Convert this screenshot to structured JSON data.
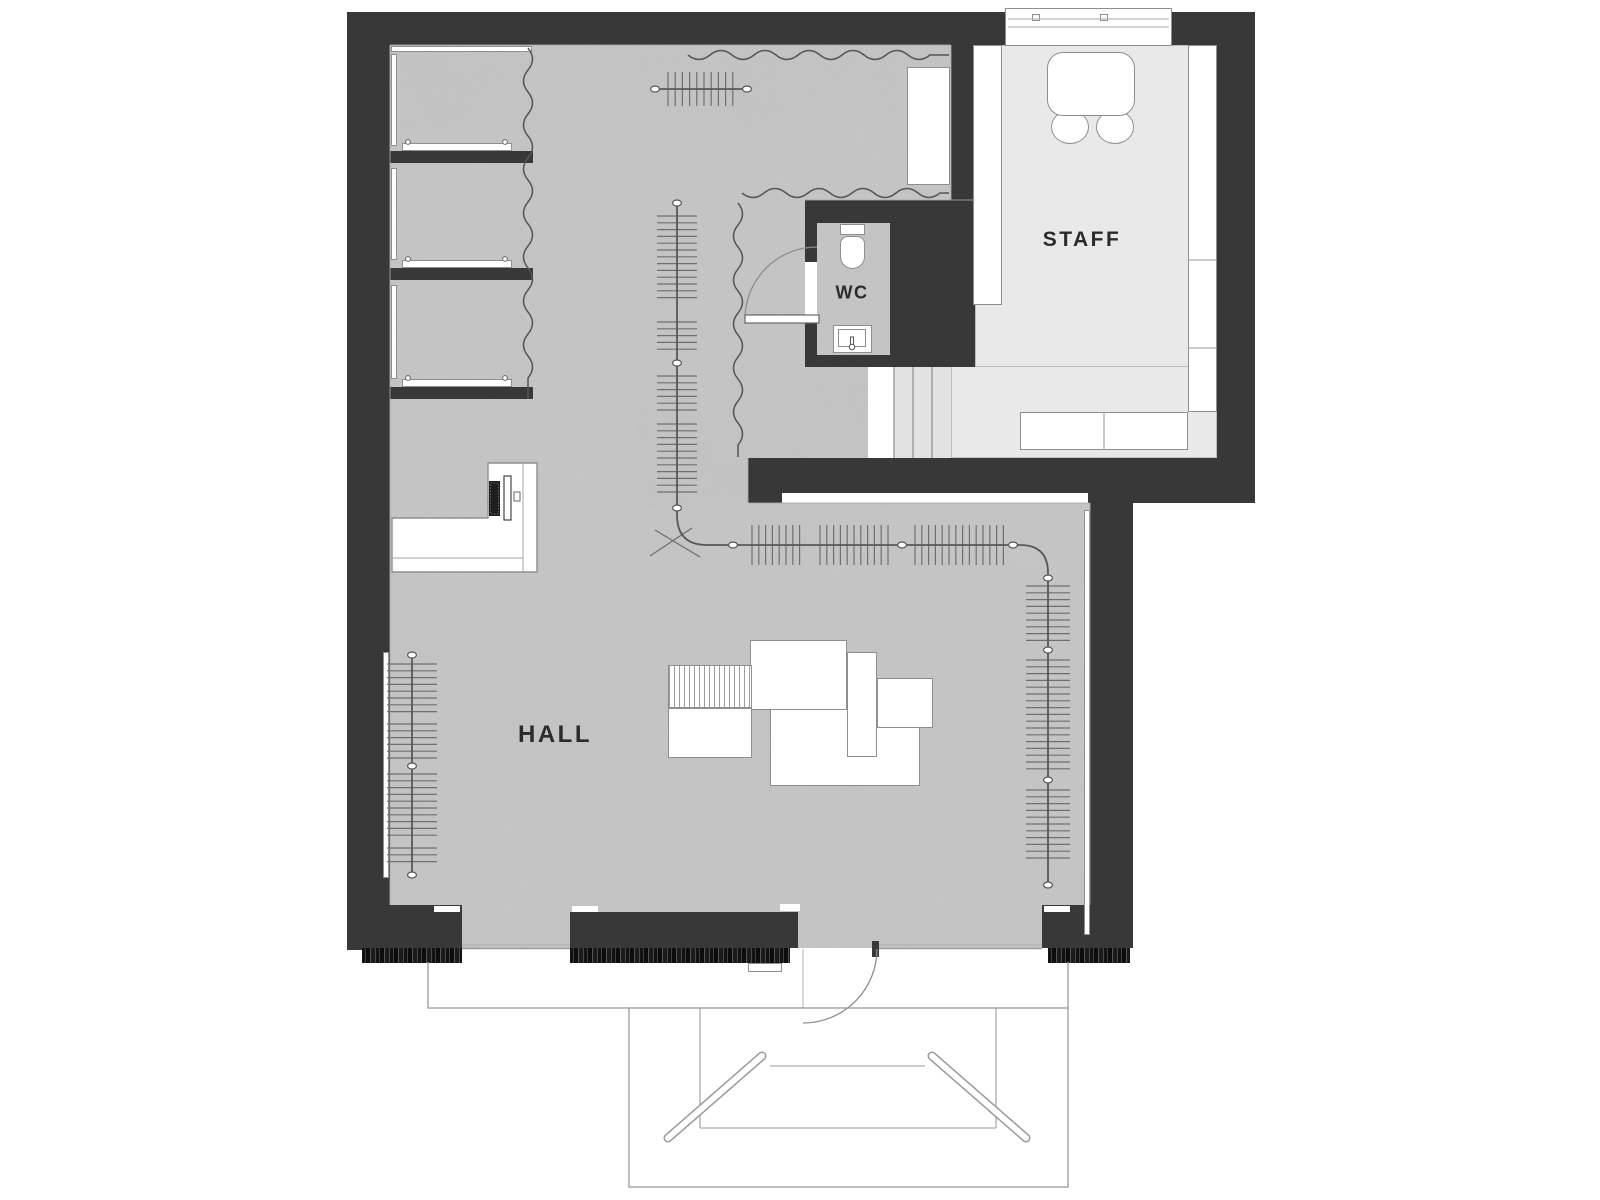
{
  "plan": {
    "type": "retail-floor-plan",
    "rooms": {
      "hall": {
        "label": "HALL"
      },
      "staff": {
        "label": "STAFF"
      },
      "wc": {
        "label": "WC"
      }
    },
    "palette": {
      "wall": "#383838",
      "hall_floor": "#c7c7c7",
      "staff_floor": "#e9e9e9",
      "stair_floor": "#e2e2e2",
      "furniture_outline": "#8f8f8f",
      "thin_line": "#9a9a9a",
      "label_color": "#2b2b2b",
      "fringe": "#141414"
    },
    "elements": {
      "fitting_booths": {
        "count": 3,
        "parts": [
          "bench-shelf",
          "mirror-strip",
          "curtain"
        ]
      },
      "clothing_racks": {
        "count": 4,
        "style": "rail-with-hangers"
      },
      "cash_counter": {
        "shape": "L",
        "equipment": [
          "keyboard",
          "monitor"
        ]
      },
      "display_tables": {
        "count": 6,
        "note": "one hatched platform"
      },
      "wc_fixtures": [
        "toilet",
        "sink",
        "door-swing"
      ],
      "staff_furniture": [
        "table",
        "chair",
        "chair",
        "cabinet-row-left",
        "cabinet-row-right",
        "counter",
        "window"
      ],
      "circulation": [
        "stairs-to-staff",
        "entrance-door-swing",
        "exterior-stair-with-handrails"
      ]
    }
  }
}
